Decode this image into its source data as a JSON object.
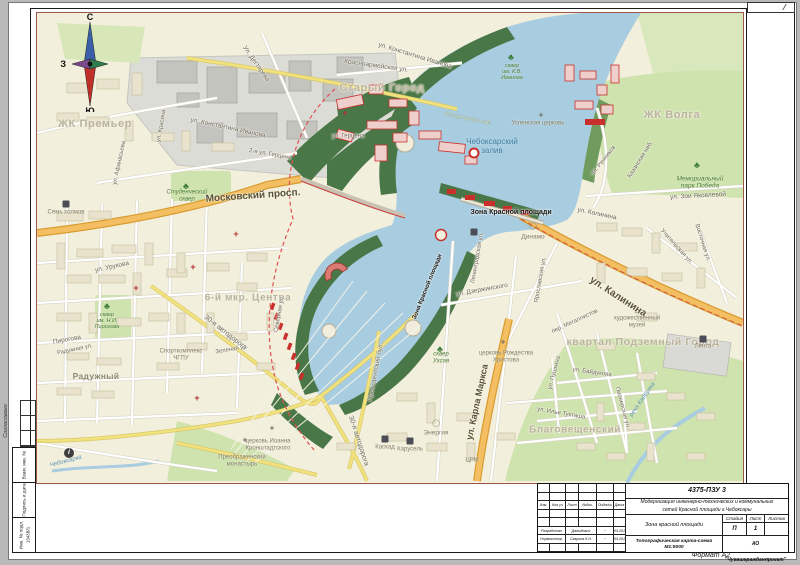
{
  "palette": {
    "land": "#f3efdd",
    "water": "#a8cde0",
    "park": "#cfe3ae",
    "park_dark": "#4a7747",
    "road_main": "#f3bf62",
    "road_main_casing": "#d89b2e",
    "road_secondary": "#f1e27e",
    "road_white": "#ffffff",
    "building": "#e9e3cd",
    "industrial": "#dcdcd6",
    "project_red": "#c9302c",
    "map_border": "#9c5a46",
    "city_label": "#b9b3a0"
  },
  "compass": {
    "north": "С",
    "south": "Ю",
    "west": "З",
    "east": "В"
  },
  "frame": {
    "approved_label": "Согласовано",
    "side_cells": [
      "Взам. инв. №",
      "Подпись и дата",
      "Инв. № подл."
    ],
    "inventory_number": "1343В/1",
    "format_label": "Формат А2"
  },
  "title_block": {
    "doc_number": "4375-ПЗУ 3",
    "project_line1": "Модернизация инженерно-технических и коммунальных",
    "project_line2": "сетей Красной площади г.Чебоксары",
    "zone": "Зона красной площади",
    "sheet_title": "Топографическая карта-схема М1:5000",
    "organization": "АО \"Чувашгражданпроект\"",
    "stage_label": "Стадия",
    "sheet_label": "Лист",
    "sheets_label": "Листов",
    "stage_value": "П",
    "sheet_value": "1",
    "sheets_value": "",
    "rev_headers": [
      "Изм.",
      "Кол.уч",
      "Лист",
      "№док.",
      "Подпись",
      "Дата"
    ],
    "rows": [
      {
        "role": "Разработал",
        "name": "Давыдович",
        "sign": "~",
        "date": "04.2017"
      },
      {
        "role": "Нормоконтр.",
        "name": "Скарина К.Н.",
        "sign": "~",
        "date": "04.2017"
      }
    ]
  },
  "map": {
    "labels": [
      {
        "t": "Старый Город",
        "x": 382,
        "y": 88,
        "s": 11,
        "c": "city"
      },
      {
        "t": "ЖК Премьер",
        "x": 95,
        "y": 124,
        "s": 11,
        "c": "city"
      },
      {
        "t": "ЖК Волга",
        "x": 672,
        "y": 115,
        "s": 11,
        "c": "city"
      },
      {
        "t": "6-й мкр. Центра",
        "x": 248,
        "y": 298,
        "s": 10,
        "c": "city"
      },
      {
        "t": "квартал Подземный Город",
        "x": 643,
        "y": 343,
        "s": 10.5,
        "c": "city"
      },
      {
        "t": "Благовещенский",
        "x": 575,
        "y": 430,
        "s": 10,
        "c": "city"
      },
      {
        "t": "Радужный",
        "x": 96,
        "y": 377,
        "s": 8.5,
        "c": "dist"
      },
      {
        "t": "Московский просп.",
        "x": 253,
        "y": 196,
        "r": -4,
        "s": 10,
        "c": "stb"
      },
      {
        "t": "ул. Калинина",
        "x": 618,
        "y": 297,
        "r": 33,
        "s": 10,
        "c": "stb"
      },
      {
        "t": "ул. Карла Маркса",
        "x": 477,
        "y": 402,
        "r": -78,
        "s": 9,
        "c": "stb"
      },
      {
        "t": "ул. Константина Иванова",
        "x": 415,
        "y": 56,
        "r": 17,
        "s": 6.5,
        "c": "st"
      },
      {
        "t": "ул. Константина Иванова",
        "x": 228,
        "y": 128,
        "r": 12,
        "s": 6.5,
        "c": "st"
      },
      {
        "t": "Красноармейская ул.",
        "x": 376,
        "y": 66,
        "r": 8,
        "s": 6.5,
        "c": "st"
      },
      {
        "t": "Ул. Дегтярева",
        "x": 256,
        "y": 64,
        "r": 55,
        "s": 6.5,
        "c": "st"
      },
      {
        "t": "ул. Афанасьева",
        "x": 120,
        "y": 163,
        "r": -78,
        "s": 6,
        "c": "st"
      },
      {
        "t": "ул. Красина",
        "x": 162,
        "y": 126,
        "r": -80,
        "s": 6,
        "c": "st"
      },
      {
        "t": "ул. Герцена",
        "x": 348,
        "y": 137,
        "s": 6,
        "c": "st"
      },
      {
        "t": "2-я ул. Герцена",
        "x": 270,
        "y": 155,
        "r": 10,
        "s": 6,
        "c": "st"
      },
      {
        "t": "ул. Урукова",
        "x": 112,
        "y": 267,
        "r": -12,
        "s": 6.5,
        "c": "st"
      },
      {
        "t": "Пирогова",
        "x": 67,
        "y": 340,
        "r": -10,
        "s": 6.5,
        "c": "st"
      },
      {
        "t": "Радужная ул.",
        "x": 75,
        "y": 350,
        "r": -12,
        "s": 5.8,
        "c": "st"
      },
      {
        "t": "Зеленая ул.",
        "x": 232,
        "y": 350,
        "r": -10,
        "s": 6,
        "c": "st"
      },
      {
        "t": "30-я автодорога",
        "x": 225,
        "y": 333,
        "r": 38,
        "s": 7,
        "c": "st"
      },
      {
        "t": "30-я автодорога",
        "x": 358,
        "y": 441,
        "r": 72,
        "s": 7,
        "c": "st"
      },
      {
        "t": "Северная ул.",
        "x": 280,
        "y": 314,
        "r": -80,
        "s": 6,
        "c": "st"
      },
      {
        "t": "пл. Речников",
        "x": 604,
        "y": 161,
        "r": -52,
        "s": 6,
        "c": "st"
      },
      {
        "t": "Казанская наб.",
        "x": 641,
        "y": 160,
        "r": -58,
        "s": 6,
        "c": "st"
      },
      {
        "t": "ул. Зои Яковлевой",
        "x": 698,
        "y": 196,
        "r": -3,
        "s": 6.5,
        "c": "st"
      },
      {
        "t": "ул. Калинина",
        "x": 597,
        "y": 214,
        "r": 12,
        "s": 6.5,
        "c": "st"
      },
      {
        "t": "пер. Металлистов",
        "x": 575,
        "y": 322,
        "r": -25,
        "s": 6,
        "c": "st"
      },
      {
        "t": "ул. Пушкина",
        "x": 555,
        "y": 373,
        "r": -75,
        "s": 6,
        "c": "st"
      },
      {
        "t": "ул. Байдукова",
        "x": 592,
        "y": 373,
        "r": 8,
        "s": 6,
        "c": "st"
      },
      {
        "t": "ул. Дзержинского",
        "x": 482,
        "y": 290,
        "r": -10,
        "s": 6.5,
        "c": "st"
      },
      {
        "t": "Ленинградская ул.",
        "x": 478,
        "y": 258,
        "r": -80,
        "s": 6,
        "c": "st"
      },
      {
        "t": "Ярославская ул.",
        "x": 541,
        "y": 280,
        "r": -80,
        "s": 6,
        "c": "st"
      },
      {
        "t": "Президентский бул.",
        "x": 376,
        "y": 372,
        "r": -79,
        "s": 6.5,
        "c": "st"
      },
      {
        "t": "ул. Ильи Тукташа",
        "x": 561,
        "y": 414,
        "r": 10,
        "s": 6,
        "c": "st"
      },
      {
        "t": "Пионерская ул.",
        "x": 622,
        "y": 408,
        "r": 75,
        "s": 6,
        "c": "st"
      },
      {
        "t": "Учительская ул.",
        "x": 676,
        "y": 247,
        "r": 48,
        "s": 6,
        "c": "st"
      },
      {
        "t": "Восточная ул.",
        "x": 702,
        "y": 243,
        "r": 72,
        "s": 6,
        "c": "st"
      },
      {
        "t": "Историческая наб.",
        "x": 468,
        "y": 119,
        "r": 12,
        "s": 5.5,
        "c": "embk"
      },
      {
        "t": "Зона Красной площади",
        "x": 511,
        "y": 213,
        "s": 7,
        "c": "zone"
      },
      {
        "t": "Зона Красной площади",
        "x": 428,
        "y": 287,
        "r": -68,
        "s": 6,
        "c": "zone"
      },
      {
        "t": "Чебоксарский\nзалив",
        "x": 492,
        "y": 147,
        "s": 8,
        "c": "wat"
      },
      {
        "t": "река Кайбулка",
        "x": 643,
        "y": 400,
        "r": -55,
        "s": 6,
        "c": "watl"
      },
      {
        "t": "Чебоксарка",
        "x": 66,
        "y": 462,
        "r": -15,
        "s": 6,
        "c": "watl"
      },
      {
        "t": "Студенческий\nсквер",
        "x": 187,
        "y": 196,
        "s": 6,
        "c": "poig"
      },
      {
        "t": "сквер\nим. Н.И.\nПирогова",
        "x": 107,
        "y": 321,
        "s": 5.5,
        "c": "poig"
      },
      {
        "t": "сквер\nУхсая",
        "x": 441,
        "y": 358,
        "s": 6,
        "c": "poig"
      },
      {
        "t": "Мемориальный\nпарк Победа",
        "x": 700,
        "y": 183,
        "s": 6.5,
        "c": "poig"
      },
      {
        "t": "сквер\nим. К.В.\nИванова",
        "x": 512,
        "y": 72,
        "s": 5.5,
        "c": "poig"
      },
      {
        "t": "Семь холмов",
        "x": 66,
        "y": 213,
        "s": 6,
        "c": "poi"
      },
      {
        "t": "Динамо",
        "x": 533,
        "y": 237,
        "s": 6.5,
        "c": "poi"
      },
      {
        "t": "Энергия",
        "x": 436,
        "y": 433,
        "s": 6.5,
        "c": "poi"
      },
      {
        "t": "Каскад",
        "x": 385,
        "y": 448,
        "s": 6,
        "c": "poi"
      },
      {
        "t": "Карусель",
        "x": 410,
        "y": 450,
        "s": 6,
        "c": "poi"
      },
      {
        "t": "Лента",
        "x": 703,
        "y": 347,
        "s": 6,
        "c": "poi"
      },
      {
        "t": "ЦРМ",
        "x": 472,
        "y": 461,
        "s": 6,
        "c": "poi"
      },
      {
        "t": "художественный\nмузей",
        "x": 637,
        "y": 322,
        "s": 6,
        "c": "poi"
      },
      {
        "t": "церковь Рождества\nХристова",
        "x": 506,
        "y": 357,
        "s": 6,
        "c": "poi"
      },
      {
        "t": "Успенская церковь",
        "x": 538,
        "y": 124,
        "s": 6,
        "c": "poi"
      },
      {
        "t": "церковь Иоанна\nКронштадтского",
        "x": 268,
        "y": 445,
        "s": 6,
        "c": "poi"
      },
      {
        "t": "Преображенский\nмонастырь",
        "x": 242,
        "y": 461,
        "s": 6,
        "c": "poi"
      },
      {
        "t": "Спорткомплекс\nЧГПУ",
        "x": 181,
        "y": 355,
        "s": 6,
        "c": "poi"
      },
      {
        "t": "♣",
        "x": 186,
        "y": 186,
        "s": 9,
        "c": "ic-tree",
        "n": "tree-icon"
      },
      {
        "t": "♣",
        "x": 697,
        "y": 165,
        "s": 9,
        "c": "ic-tree",
        "n": "tree-icon"
      },
      {
        "t": "♣",
        "x": 107,
        "y": 306,
        "s": 9,
        "c": "ic-tree",
        "n": "tree-icon"
      },
      {
        "t": "♣",
        "x": 440,
        "y": 349,
        "s": 9,
        "c": "ic-tree",
        "n": "tree-icon"
      },
      {
        "t": "♣",
        "x": 511,
        "y": 57,
        "s": 9,
        "c": "ic-tree",
        "n": "tree-icon"
      },
      {
        "t": "",
        "x": 66,
        "y": 204,
        "c": "ic-shop",
        "n": "shop-icon"
      },
      {
        "t": "",
        "x": 385,
        "y": 439,
        "c": "ic-shop",
        "n": "shop-icon"
      },
      {
        "t": "",
        "x": 410,
        "y": 441,
        "c": "ic-shop",
        "n": "shop-icon"
      },
      {
        "t": "",
        "x": 703,
        "y": 339,
        "c": "ic-shop",
        "n": "shop-icon"
      },
      {
        "t": "",
        "x": 474,
        "y": 232,
        "c": "ic-shop",
        "n": "shop-icon"
      },
      {
        "t": "⌂",
        "x": 637,
        "y": 310,
        "s": 9,
        "c": "ic-mus",
        "n": "museum-icon"
      },
      {
        "t": "◯",
        "x": 533,
        "y": 227,
        "s": 7,
        "c": "ic-stad",
        "n": "stadium-icon"
      },
      {
        "t": "◯",
        "x": 436,
        "y": 424,
        "s": 7,
        "c": "ic-stad",
        "n": "stadium-icon"
      },
      {
        "t": "i",
        "x": 69,
        "y": 453,
        "c": "ic-info",
        "n": "info-icon"
      },
      {
        "t": "+",
        "x": 136,
        "y": 288,
        "s": 9,
        "c": "ic-crossr",
        "n": "hospital-icon"
      },
      {
        "t": "+",
        "x": 236,
        "y": 234,
        "s": 9,
        "c": "ic-crossr",
        "n": "hospital-icon"
      },
      {
        "t": "+",
        "x": 193,
        "y": 267,
        "s": 9,
        "c": "ic-crossr",
        "n": "hospital-icon"
      },
      {
        "t": "+",
        "x": 197,
        "y": 398,
        "s": 9,
        "c": "ic-crossr",
        "n": "hospital-icon"
      },
      {
        "t": "+",
        "x": 345,
        "y": 113,
        "s": 9,
        "c": "ic-crossr",
        "n": "hospital-icon"
      },
      {
        "t": "+",
        "x": 503,
        "y": 343,
        "s": 8,
        "c": "ic-crossg",
        "n": "church-icon"
      },
      {
        "t": "+",
        "x": 245,
        "y": 441,
        "s": 8,
        "c": "ic-crossg",
        "n": "church-icon"
      },
      {
        "t": "+",
        "x": 272,
        "y": 429,
        "s": 8,
        "c": "ic-crossg",
        "n": "church-icon"
      },
      {
        "t": "+",
        "x": 541,
        "y": 116,
        "s": 8,
        "c": "ic-crossg",
        "n": "church-icon"
      },
      {
        "t": "",
        "x": 474,
        "y": 153,
        "c": "ic-mon",
        "n": "monument-icon"
      }
    ]
  }
}
